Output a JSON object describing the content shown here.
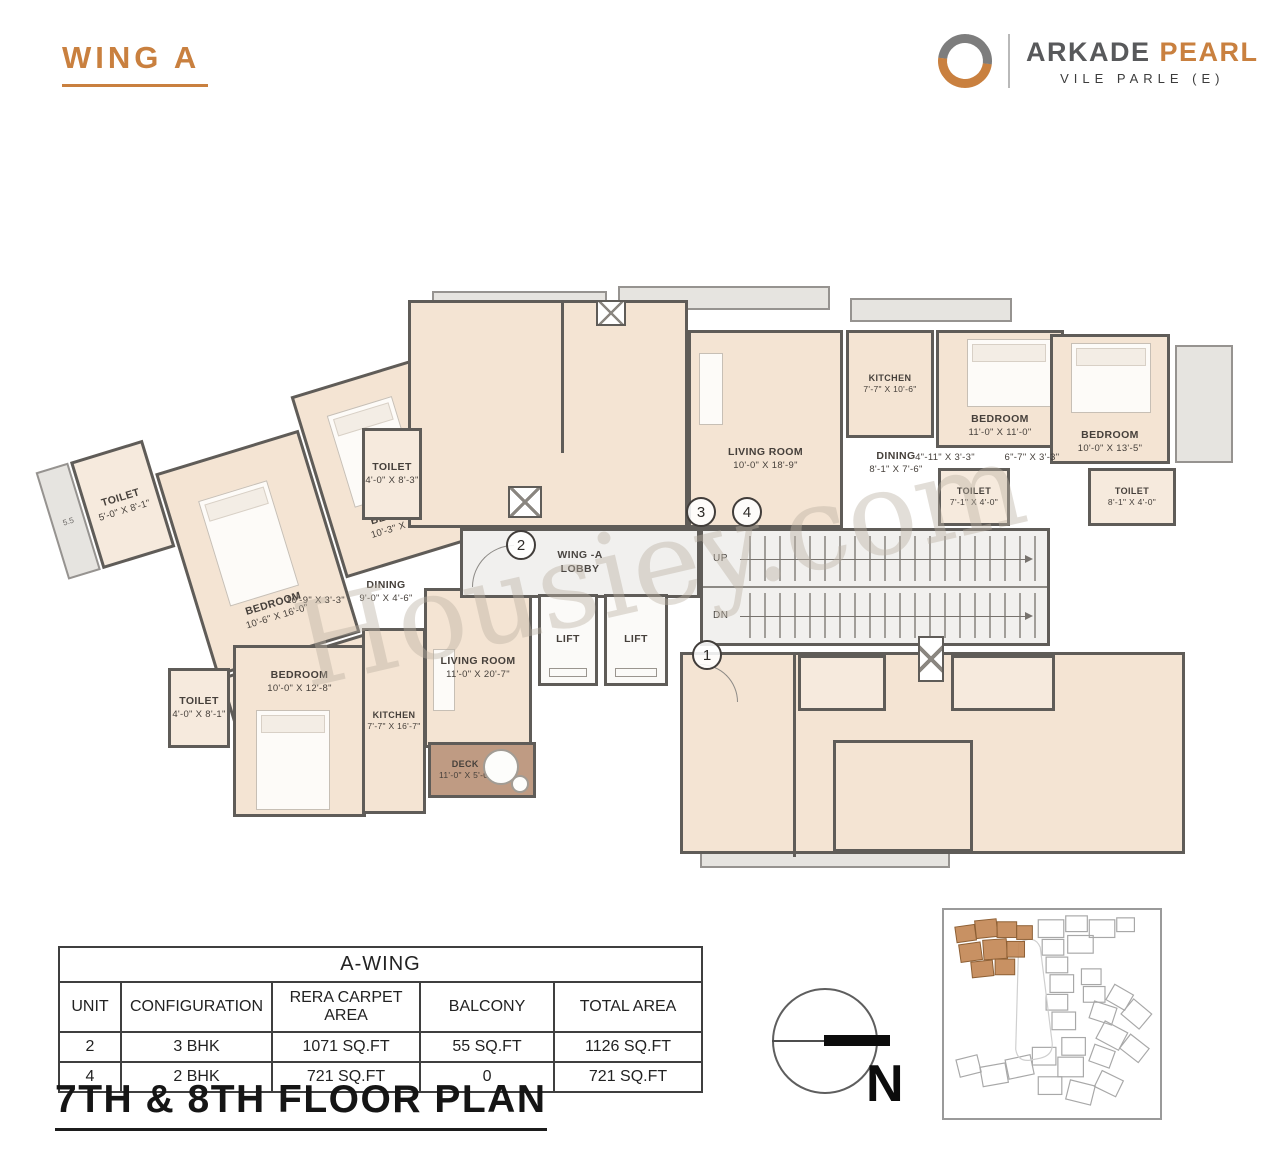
{
  "header": {
    "wing_title": "WING A",
    "brand": {
      "name_primary": "ARKADE",
      "name_secondary": "PEARL",
      "location": "VILE PARLE (E)"
    }
  },
  "watermark": {
    "text": "Housiey.com"
  },
  "plan": {
    "lobby_line1": "WING -A",
    "lobby_line2": "LOBBY",
    "lift_label": "LIFT",
    "up_label": "UP",
    "dn_label": "DN",
    "ledge_label": "5.5",
    "units": [
      "1",
      "2",
      "3",
      "4"
    ],
    "rooms": [
      {
        "name": "TOILET",
        "dims": "5'-0\" X 8'-1\""
      },
      {
        "name": "BEDROOM",
        "dims": "10'-6\" X 16'-0\""
      },
      {
        "name": "BEDROOM",
        "dims": "10'-3\" X 14'-0\""
      },
      {
        "name": "TOILET",
        "dims": "6'-5\" X 3'-7\""
      },
      {
        "name": "",
        "dims": "3'-3\" X 4'-1\""
      },
      {
        "name": "TOILET",
        "dims": "4'-0\" X 8'-3\""
      },
      {
        "name": "",
        "dims": "10'-9\" X 3'-3\""
      },
      {
        "name": "DINING",
        "dims": "9'-0\" X 4'-6\""
      },
      {
        "name": "LIVING ROOM",
        "dims": "11'-0\" X 20'-7\""
      },
      {
        "name": "TOILET",
        "dims": "4'-0\" X 8'-1\""
      },
      {
        "name": "BEDROOM",
        "dims": "10'-0\" X 12'-8\""
      },
      {
        "name": "KITCHEN",
        "dims": "7'-7\" X 16'-7\""
      },
      {
        "name": "DECK",
        "dims": "11'-0\" X 5'-0\""
      },
      {
        "name": "LIVING ROOM",
        "dims": "10'-0\" X 18'-9\""
      },
      {
        "name": "KITCHEN",
        "dims": "7'-7\" X 10'-6\""
      },
      {
        "name": "DINING",
        "dims": "8'-1\" X 7'-6\""
      },
      {
        "name": "BEDROOM",
        "dims": "11'-0\" X 11'-0\""
      },
      {
        "name": "BEDROOM",
        "dims": "10'-0\" X 13'-5\""
      },
      {
        "name": "",
        "dims": "4\"-11\" X 3'-3\""
      },
      {
        "name": "",
        "dims": "6\"-7\" X 3'-3\""
      },
      {
        "name": "TOILET",
        "dims": "7'-1\" X 4'-0\""
      },
      {
        "name": "TOILET",
        "dims": "8'-1\" X 4'-0\""
      }
    ]
  },
  "table": {
    "title": "A-WING",
    "columns": [
      "UNIT",
      "CONFIGURATION",
      "RERA  CARPET AREA",
      "BALCONY",
      "TOTAL AREA"
    ],
    "rows": [
      [
        "2",
        "3 BHK",
        "1071 SQ.FT",
        "55 SQ.FT",
        "1126 SQ.FT"
      ],
      [
        "4",
        "2 BHK",
        "721 SQ.FT",
        "0",
        "721 SQ.FT"
      ]
    ]
  },
  "footer": {
    "title": "7TH & 8TH FLOOR PLAN"
  },
  "compass": {
    "north_label": "N"
  },
  "colors": {
    "accent_orange": "#c9803f",
    "wall_gray": "#5f5c58",
    "room_fill": "#f4e4d3",
    "deck_fill": "#bf9b83",
    "lobby_fill": "#f1f0ee"
  }
}
